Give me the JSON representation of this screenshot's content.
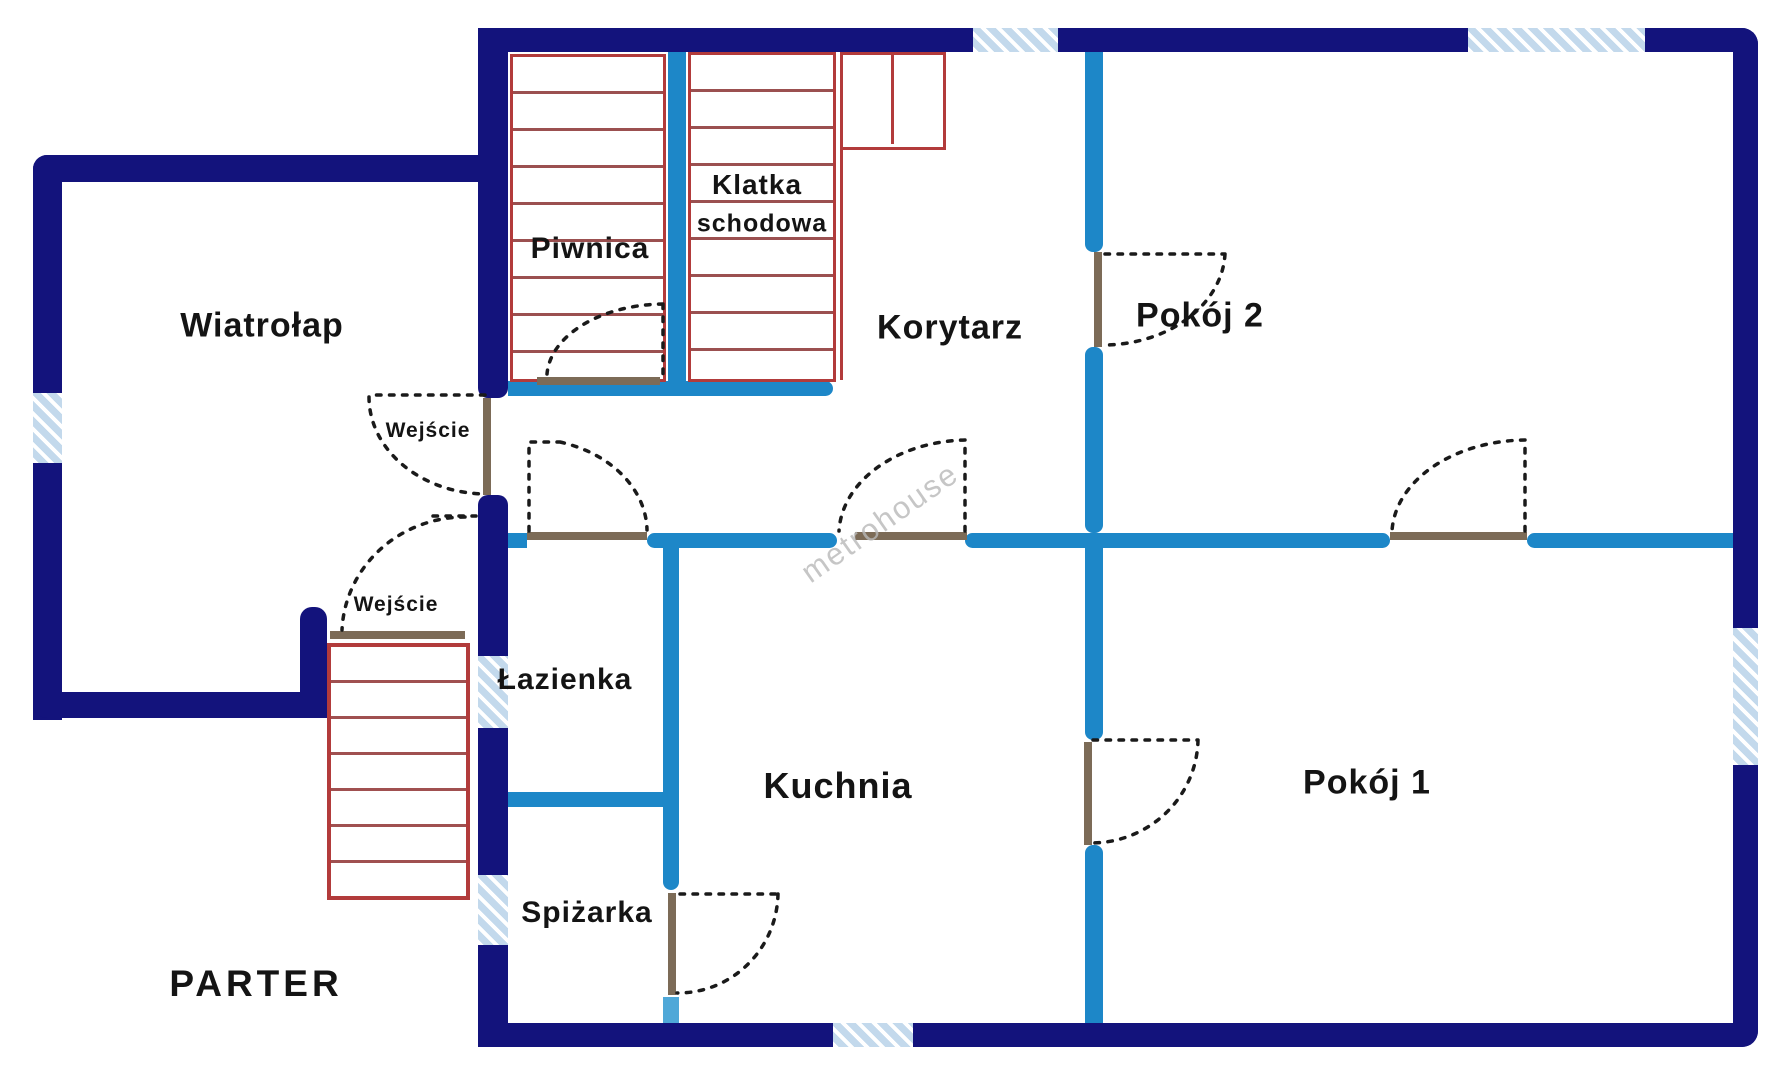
{
  "floor_plan": {
    "floor_label": "PARTER",
    "watermark": "metrohouse",
    "rooms": [
      {
        "id": "wiatrolap",
        "label": "Wiatrołap"
      },
      {
        "id": "piwnica",
        "label": "Piwnica"
      },
      {
        "id": "klatka-schodowa",
        "label": "Klatka",
        "label2": "schodowa"
      },
      {
        "id": "korytarz",
        "label": "Korytarz"
      },
      {
        "id": "pokoj2",
        "label": "Pokój 2"
      },
      {
        "id": "pokoj1",
        "label": "Pokój 1"
      },
      {
        "id": "kuchnia",
        "label": "Kuchnia"
      },
      {
        "id": "lazienka",
        "label": "Łazienka"
      },
      {
        "id": "spizarka",
        "label": "Spiżarka"
      }
    ],
    "entrances": {
      "upper": "Wejście",
      "lower": "Wejście"
    },
    "colors": {
      "outer_wall": "#13137c",
      "interior_wall": "#1d87c8",
      "window_fill": "#c3d9ec",
      "stairs_red": "#b23b3b",
      "door_leaf": "#7c6b57",
      "label_text": "#141414",
      "watermark_gray": "#b9b9b9"
    }
  }
}
